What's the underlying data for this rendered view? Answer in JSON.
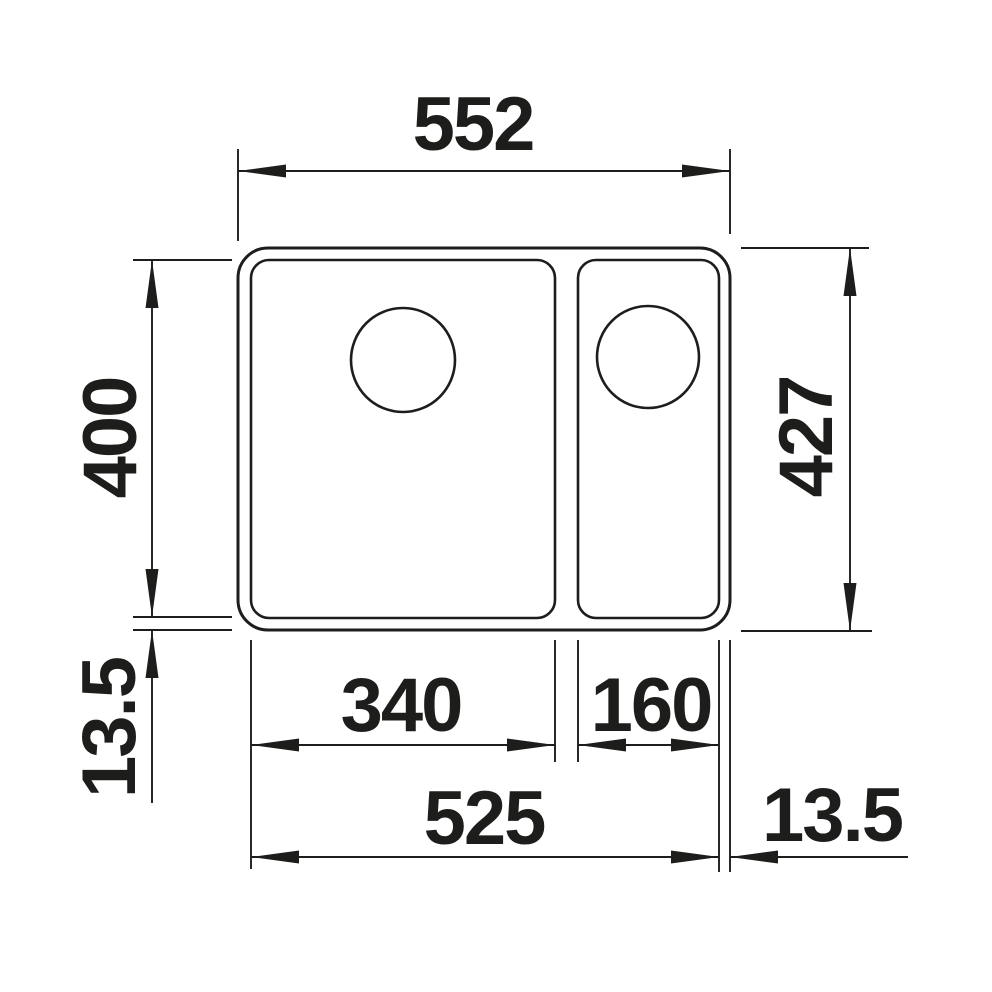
{
  "colors": {
    "background": "#ffffff",
    "ink": "#1d1d1b"
  },
  "drawing": {
    "description": "Top-view technical dimension drawing of a sink with one main bowl and one half bowl, each bowl with a round drain hole",
    "labels": {
      "overall_width": "552",
      "bowl_inner_depth": "400",
      "rim_offset_left": "13.5",
      "overall_depth": "427",
      "main_bowl_width": "340",
      "half_bowl_width": "160",
      "inner_width_total": "525",
      "rim_offset_right": "13.5"
    }
  }
}
